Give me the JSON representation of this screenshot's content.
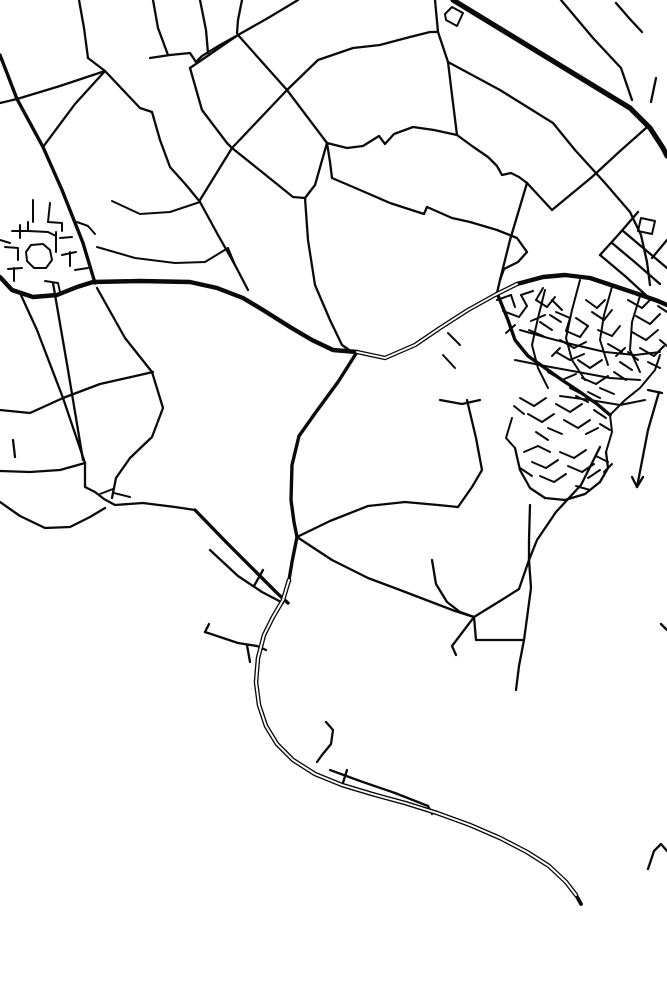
{
  "map": {
    "width": 667,
    "height": 1000,
    "background": "#ffffff",
    "stroke": "#0a0a0a",
    "style": "minimal-road-network-poster",
    "widths": {
      "village": 2.0,
      "thin": 2.3,
      "med": 3.4,
      "thick": 4.4,
      "hwy": 5.2
    },
    "roads": [
      {
        "name": "top-vertical-1",
        "w": 2.3,
        "pts": "79,0 84,28 88,58"
      },
      {
        "name": "top-vertical-2",
        "w": 2.3,
        "pts": "153,0 158,28 168,55"
      },
      {
        "name": "top-vertical-3",
        "w": 2.3,
        "pts": "200,0 206,30 208,53"
      },
      {
        "name": "top-vertical-4",
        "w": 2.3,
        "pts": "242,0 238,20 237,33"
      },
      {
        "name": "top-diagonal-5",
        "w": 2.3,
        "pts": "298,0 268,18 238,35"
      },
      {
        "name": "wavy-top-lane",
        "w": 2.3,
        "pts": "150,58 170,55 190,53 196,62 202,56 220,45 238,35"
      },
      {
        "name": "left-cross-road",
        "w": 2.3,
        "pts": "0,103 17,99 60,86 105,71"
      },
      {
        "name": "junction-link",
        "w": 2.3,
        "pts": "88,58 105,71"
      },
      {
        "name": "village-approach-road",
        "w": 3.4,
        "pts": "0,55 17,99 43,147 62,190 83,243 95,283"
      },
      {
        "name": "mesh-edge-a",
        "w": 2.3,
        "pts": "105,71 75,104 43,147"
      },
      {
        "name": "mesh-long-diag",
        "w": 2.3,
        "pts": "105,71 140,108 152,112 160,140 170,167 187,186 200,202"
      },
      {
        "name": "mesh-to-village",
        "w": 2.3,
        "pts": "200,202 218,235 235,265 248,290"
      },
      {
        "name": "rect-top-edge",
        "w": 2.3,
        "pts": "238,35 190,68"
      },
      {
        "name": "rect-left-edge",
        "w": 2.3,
        "pts": "190,68 202,110 227,143 232,148"
      },
      {
        "name": "rect-right-edge",
        "w": 2.3,
        "pts": "238,35 287,90 327,143"
      },
      {
        "name": "long-sw-ne-road",
        "w": 2.3,
        "pts": "200,200 232,148 287,90 318,60 353,48 380,45 410,37 430,32 438,32"
      },
      {
        "name": "rect-bottom-edge",
        "w": 2.3,
        "pts": "232,148 262,172 293,197 305,198"
      },
      {
        "name": "rect-corner-drop",
        "w": 2.3,
        "pts": "327,143 315,185 305,198"
      },
      {
        "name": "center-south-link",
        "w": 2.3,
        "pts": "305,198 308,240 315,285 330,320 342,345 352,352"
      },
      {
        "name": "j3-drop",
        "w": 2.3,
        "pts": "327,143 330,162 332,178"
      },
      {
        "name": "nw-town-feeder",
        "w": 2.3,
        "pts": "332,178 360,190 390,203 424,214 427,207 452,218 470,222 497,230 517,238 527,252 518,262 504,269 500,280"
      },
      {
        "name": "loop-lane",
        "w": 2.3,
        "pts": "327,143 347,148 363,146 379,136 385,144 394,134 413,127 434,130 457,135"
      },
      {
        "name": "loop-lane-east",
        "w": 2.3,
        "pts": "457,135 472,146 488,157 497,166 502,175 511,173 519,177 527,183"
      },
      {
        "name": "v-notch-drop",
        "w": 2.3,
        "pts": "527,183 510,240 500,280"
      },
      {
        "name": "arc-connector",
        "w": 2.3,
        "pts": "500,280 497,293"
      },
      {
        "name": "hwy-stub-top",
        "w": 2.3,
        "pts": "435,0 438,32"
      },
      {
        "name": "hwy-parallel-drop",
        "w": 2.3,
        "pts": "438,32 448,62 452,95 457,135"
      },
      {
        "name": "motorway",
        "w": 5.2,
        "pts": "453,0 630,108 650,128 663,148 667,156"
      },
      {
        "name": "small-parallelogram",
        "w": 2.0,
        "pts": "445,14 452,7 463,13 457,26 446,20 445,14"
      },
      {
        "name": "ne-diagonal-a",
        "w": 2.3,
        "pts": "561,0 593,38 621,68 632,100"
      },
      {
        "name": "ne-diagonal-b",
        "w": 2.3,
        "pts": "616,3 629,18 642,32"
      },
      {
        "name": "ne-tick",
        "w": 2.3,
        "pts": "656,78 651,102"
      },
      {
        "name": "cross-diag-l2",
        "w": 2.3,
        "pts": "646,128 619,152 592,177 552,210"
      },
      {
        "name": "hwy-parallel-lane",
        "w": 2.3,
        "pts": "448,62 500,90 553,123 575,150"
      },
      {
        "name": "cross-diag-l1",
        "w": 2.3,
        "pts": "575,150 605,183 630,212 641,235 647,262 650,285"
      },
      {
        "name": "v-notch-west",
        "w": 2.3,
        "pts": "527,183 552,210"
      },
      {
        "name": "pier-hatch-1",
        "w": 2.3,
        "pts": "600,255 625,276 648,297"
      },
      {
        "name": "pier-hatch-2",
        "w": 2.3,
        "pts": "612,243 637,264 660,284"
      },
      {
        "name": "pier-hatch-3",
        "w": 2.3,
        "pts": "623,231 648,252 667,268"
      },
      {
        "name": "pier-cross",
        "w": 2.3,
        "pts": "638,212 619,234 600,255"
      },
      {
        "name": "pier-square",
        "w": 2.0,
        "pts": "641,218 655,221 652,234 638,231 641,218"
      },
      {
        "name": "pier-edge-tick",
        "w": 2.3,
        "pts": "667,240 652,258"
      },
      {
        "name": "right-edge-mark",
        "w": 2.3,
        "pts": "661,624 667,630"
      },
      {
        "name": "main-west-east-road",
        "w": 4.4,
        "pts": "0,277 12,290 33,297 57,295 77,287 93,282 140,281 190,282 217,288 243,298 263,310 290,327 312,340 333,350 357,352"
      },
      {
        "name": "ring-arc-west",
        "w": 4.4,
        "double": true,
        "pts": "357,352 385,358 415,345 440,328 468,310 495,295 517,284"
      },
      {
        "name": "ring-arc-east",
        "w": 4.4,
        "pts": "517,284 543,277 565,275 590,278 614,286 638,294 658,301 667,305"
      },
      {
        "name": "village-st-1",
        "w": 2.0,
        "pts": "33,200 33,222"
      },
      {
        "name": "village-st-2",
        "w": 2.0,
        "pts": "50,203 48,222"
      },
      {
        "name": "village-st-3",
        "w": 2.0,
        "pts": "12,231 28,231 48,232 56,236"
      },
      {
        "name": "village-st-4",
        "w": 2.0,
        "pts": "20,225 20,238"
      },
      {
        "name": "village-st-5",
        "w": 2.0,
        "pts": "28,222 28,231"
      },
      {
        "name": "village-ring",
        "w": 2.0,
        "pts": "26,252 31,245 43,244 50,250 52,260 46,268 34,268 27,261 26,252"
      },
      {
        "name": "village-st-6",
        "w": 2.0,
        "pts": "5,247 18,248 18,260"
      },
      {
        "name": "village-st-7",
        "w": 2.0,
        "pts": "8,269 22,268"
      },
      {
        "name": "village-st-8",
        "w": 2.0,
        "pts": "14,268 14,281"
      },
      {
        "name": "village-st-9",
        "w": 2.0,
        "pts": "56,232 56,252"
      },
      {
        "name": "village-st-10",
        "w": 2.0,
        "pts": "60,238 72,237"
      },
      {
        "name": "village-st-11",
        "w": 2.0,
        "pts": "62,255 76,252"
      },
      {
        "name": "village-st-12",
        "w": 2.0,
        "pts": "70,252 70,266"
      },
      {
        "name": "village-st-13",
        "w": 2.0,
        "pts": "45,281 58,283 60,292"
      },
      {
        "name": "village-st-14",
        "w": 2.0,
        "pts": "75,270 88,268"
      },
      {
        "name": "village-st-15",
        "w": 2.0,
        "pts": "48,222 62,223 62,231"
      },
      {
        "name": "village-st-16",
        "w": 2.0,
        "pts": "0,240 10,243"
      },
      {
        "name": "village-st-17",
        "w": 2.0,
        "pts": "77,222 88,226 95,234"
      },
      {
        "name": "village-feeder-n",
        "w": 2.0,
        "pts": "112,201 140,214 170,212 200,202"
      },
      {
        "name": "village-feeder-e",
        "w": 2.0,
        "pts": "97,247 135,258 175,263 205,262 228,248"
      },
      {
        "name": "village-feeder-ne",
        "w": 2.0,
        "pts": "228,248 235,265"
      },
      {
        "name": "sw-stub",
        "w": 2.3,
        "pts": "13,440 15,457"
      },
      {
        "name": "sw-horizontal",
        "w": 2.3,
        "pts": "0,471 30,472 60,470 85,463"
      },
      {
        "name": "sw-long-diag-a",
        "w": 2.3,
        "pts": "20,293 37,330 63,398 85,463"
      },
      {
        "name": "sw-long-diag-b",
        "w": 2.3,
        "pts": "53,283 68,370 83,460"
      },
      {
        "name": "sw-cross-road",
        "w": 2.3,
        "pts": "0,410 30,413 63,398 100,384 153,372"
      },
      {
        "name": "sw-curve-road",
        "w": 2.3,
        "pts": "97,288 125,338 152,372 163,408 152,437 130,458 116,478 112,498"
      },
      {
        "name": "sw-wavy-road",
        "w": 2.3,
        "pts": "85,463 85,487 95,492 104,499 115,505 143,503 175,507 195,510"
      },
      {
        "name": "sw-lower-wavy",
        "w": 2.3,
        "pts": "0,502 20,516 45,528 70,527 90,517 105,508"
      },
      {
        "name": "sw-dash-a",
        "w": 2.0,
        "pts": "100,494 113,489"
      },
      {
        "name": "sw-dash-b",
        "w": 2.0,
        "pts": "114,493 130,497"
      },
      {
        "name": "sw-to-main-diag",
        "w": 3.4,
        "pts": "195,510 227,543 257,573 278,594 288,603"
      },
      {
        "name": "sw-tick",
        "w": 2.3,
        "pts": "263,570 254,586"
      },
      {
        "name": "main-south-upper",
        "w": 3.4,
        "pts": "357,352 338,382 316,412 299,436 292,465 291,500 294,522 297,537"
      },
      {
        "name": "main-south-neck",
        "w": 3.4,
        "pts": "297,537 292,562 289,580"
      },
      {
        "name": "main-south-sweep",
        "w": 4.6,
        "double": true,
        "pts": "289,580 283,600 273,617 264,635 258,658 256,682 259,705 266,726 277,744 293,760 315,774 342,785 372,794 405,803 437,813 470,825 500,838 527,852 549,866 566,882 576,895"
      },
      {
        "name": "main-south-tip",
        "w": 3.8,
        "pts": "576,895 581,904"
      },
      {
        "name": "south-companion-lane",
        "w": 2.3,
        "pts": "210,550 238,576 262,592 283,603"
      },
      {
        "name": "bottom-branch-hook",
        "w": 2.3,
        "pts": "205,632 209,624"
      },
      {
        "name": "bottom-branch",
        "w": 2.3,
        "pts": "205,632 238,643 257,646 266,650"
      },
      {
        "name": "bottom-branch-stub",
        "w": 2.3,
        "pts": "247,645 250,662"
      },
      {
        "name": "j-hook",
        "w": 2.3,
        "pts": "326,722 333,730 331,744 322,755 317,762"
      },
      {
        "name": "bottom-side-lane",
        "w": 2.3,
        "pts": "330,770 360,781 395,793 428,806"
      },
      {
        "name": "bottom-side-tip",
        "w": 2.3,
        "pts": "428,806 432,814"
      },
      {
        "name": "bottom-cross-tick",
        "w": 2.3,
        "pts": "347,770 342,786"
      },
      {
        "name": "bottom-right-arch",
        "w": 2.3,
        "pts": "648,869 654,851 661,844 667,851"
      },
      {
        "name": "breakwater-diag",
        "w": 2.3,
        "pts": "659,392 648,430 637,487"
      },
      {
        "name": "breakwater-fork-a",
        "w": 2.3,
        "pts": "637,487 632,477"
      },
      {
        "name": "breakwater-fork-b",
        "w": 2.3,
        "pts": "637,487 643,477"
      },
      {
        "name": "breakwater-top-tick",
        "w": 2.3,
        "pts": "648,390 662,393"
      },
      {
        "name": "se-link-road",
        "w": 2.3,
        "pts": "297,537 332,560 368,578 400,590 434,603"
      },
      {
        "name": "se-curve-down",
        "w": 2.3,
        "pts": "432,560 436,584 447,602 460,612 474,617"
      },
      {
        "name": "se-link-tail",
        "w": 2.3,
        "pts": "434,603 455,611 474,617"
      },
      {
        "name": "se-hook-branch",
        "w": 2.3,
        "pts": "474,617 452,646 456,655"
      },
      {
        "name": "se-horizontal",
        "w": 2.3,
        "pts": "474,617 476,640 524,640"
      },
      {
        "name": "se-vertical",
        "w": 2.3,
        "pts": "529,560 531,588 527,618 524,640"
      },
      {
        "name": "se-south-drop",
        "w": 2.3,
        "pts": "524,640 519,666 516,690"
      },
      {
        "name": "se-up-link",
        "w": 2.3,
        "pts": "474,617 500,601 519,589 529,560"
      },
      {
        "name": "se-east-slope",
        "w": 2.3,
        "pts": "600,447 581,485 556,512 537,540 529,560"
      },
      {
        "name": "se-cluster-drop",
        "w": 2.3,
        "pts": "530,505 529,540 529,560"
      },
      {
        "name": "sw-se-connector",
        "w": 2.3,
        "pts": "297,537 330,521 368,506 405,502 438,505 458,507"
      },
      {
        "name": "town-west-lane",
        "w": 2.3,
        "pts": "440,400 462,404 480,400"
      },
      {
        "name": "town-west-slope",
        "w": 2.3,
        "pts": "467,400 476,438 482,470 472,487 458,507"
      },
      {
        "name": "arc-stub-a",
        "w": 2.0,
        "pts": "448,333 460,345"
      },
      {
        "name": "arc-stub-b",
        "w": 2.0,
        "pts": "443,355 455,368"
      },
      {
        "name": "town-spine",
        "w": 3.4,
        "pts": "497,293 508,320 515,340 528,356 545,368 562,380 580,392 597,404 610,415"
      },
      {
        "name": "town-ns-1",
        "w": 2.0,
        "pts": "545,290 538,318 532,345 538,368 548,388"
      },
      {
        "name": "town-ns-2",
        "w": 2.0,
        "pts": "580,280 572,310 566,338 572,360 585,380"
      },
      {
        "name": "town-ns-3",
        "w": 2.0,
        "pts": "612,287 604,315 600,340 608,365"
      },
      {
        "name": "town-ns-4",
        "w": 2.0,
        "pts": "640,296 632,322 630,350 640,372"
      },
      {
        "name": "town-ew-1",
        "w": 2.0,
        "pts": "520,330 548,338 575,345 605,352 635,355 660,352"
      },
      {
        "name": "town-ew-2",
        "w": 2.0,
        "pts": "515,360 545,366 578,372 610,378 640,380"
      },
      {
        "name": "town-ew-3",
        "w": 2.0,
        "pts": "560,396 590,400 620,405 645,400"
      },
      {
        "name": "town-se-bound",
        "w": 2.0,
        "pts": "610,415 625,400 640,388 655,370 660,355"
      },
      {
        "name": "town-s-bound-a",
        "w": 2.0,
        "pts": "512,418 506,438 515,448"
      },
      {
        "name": "town-s-bound-b",
        "w": 2.0,
        "pts": "610,415 612,432 606,452"
      },
      {
        "name": "cluster-bound-w",
        "w": 2.3,
        "pts": "515,448 520,470 530,488 545,498"
      },
      {
        "name": "cluster-bound-s",
        "w": 2.3,
        "pts": "545,498 565,500 585,494 600,482"
      },
      {
        "name": "cluster-bound-e",
        "w": 2.3,
        "pts": "600,482 608,468 606,452"
      }
    ],
    "town_blocks": [
      "497,300 511,295",
      "511,295 515,307",
      "503,311 519,317",
      "519,317 527,306",
      "527,306 521,295",
      "521,295 533,291",
      "531,321 545,315",
      "536,300 547,307",
      "547,307 555,297",
      "543,288 536,300",
      "550,315 561,322",
      "529,330 543,336",
      "515,325 506,333",
      "552,300 562,310",
      "540,322 552,330",
      "556,312 570,318",
      "570,318 566,331",
      "566,331 580,337",
      "580,337 588,326",
      "588,326 576,318",
      "560,340 574,348",
      "574,348 586,342",
      "586,300 597,308",
      "597,308 605,300",
      "592,312 604,320",
      "604,320 612,310",
      "598,330 612,336",
      "612,336 620,326",
      "556,352 570,360",
      "570,360 584,354",
      "578,360 590,368",
      "590,368 602,360",
      "608,344 622,352",
      "616,356 625,348",
      "548,372 562,380",
      "562,380 576,374",
      "582,378 596,384",
      "596,384 608,376",
      "600,388 614,394",
      "588,392 600,398",
      "570,388 582,394",
      "552,356 560,348",
      "620,362 632,370",
      "614,372 626,380",
      "628,300 642,308",
      "642,308 652,298",
      "636,316 650,324",
      "650,324 660,314",
      "632,332 646,340",
      "646,340 658,330",
      "640,348 654,356",
      "654,356 664,346",
      "628,352 638,360",
      "648,362 660,368",
      "660,340 667,346",
      "658,306 667,312",
      "520,398 534,406",
      "534,406 546,398",
      "528,414 542,422",
      "542,422 554,414",
      "548,428 562,434",
      "536,432 548,440",
      "556,404 570,412",
      "570,412 582,404",
      "564,420 578,428",
      "578,428 590,420",
      "586,434 598,428",
      "576,396 588,402",
      "594,410 606,418",
      "600,424 610,430",
      "514,406 524,414",
      "524,452 538,446",
      "538,446 550,452",
      "532,462 546,468",
      "546,468 558,460",
      "540,476 554,482",
      "554,482 566,474",
      "560,452 574,458",
      "574,458 586,450",
      "568,466 582,472",
      "582,472 594,464",
      "588,478 600,470",
      "576,486 590,490",
      "520,468 532,476",
      "596,456 608,462",
      "604,472 612,464"
    ],
    "town_block_width": 2.0
  }
}
